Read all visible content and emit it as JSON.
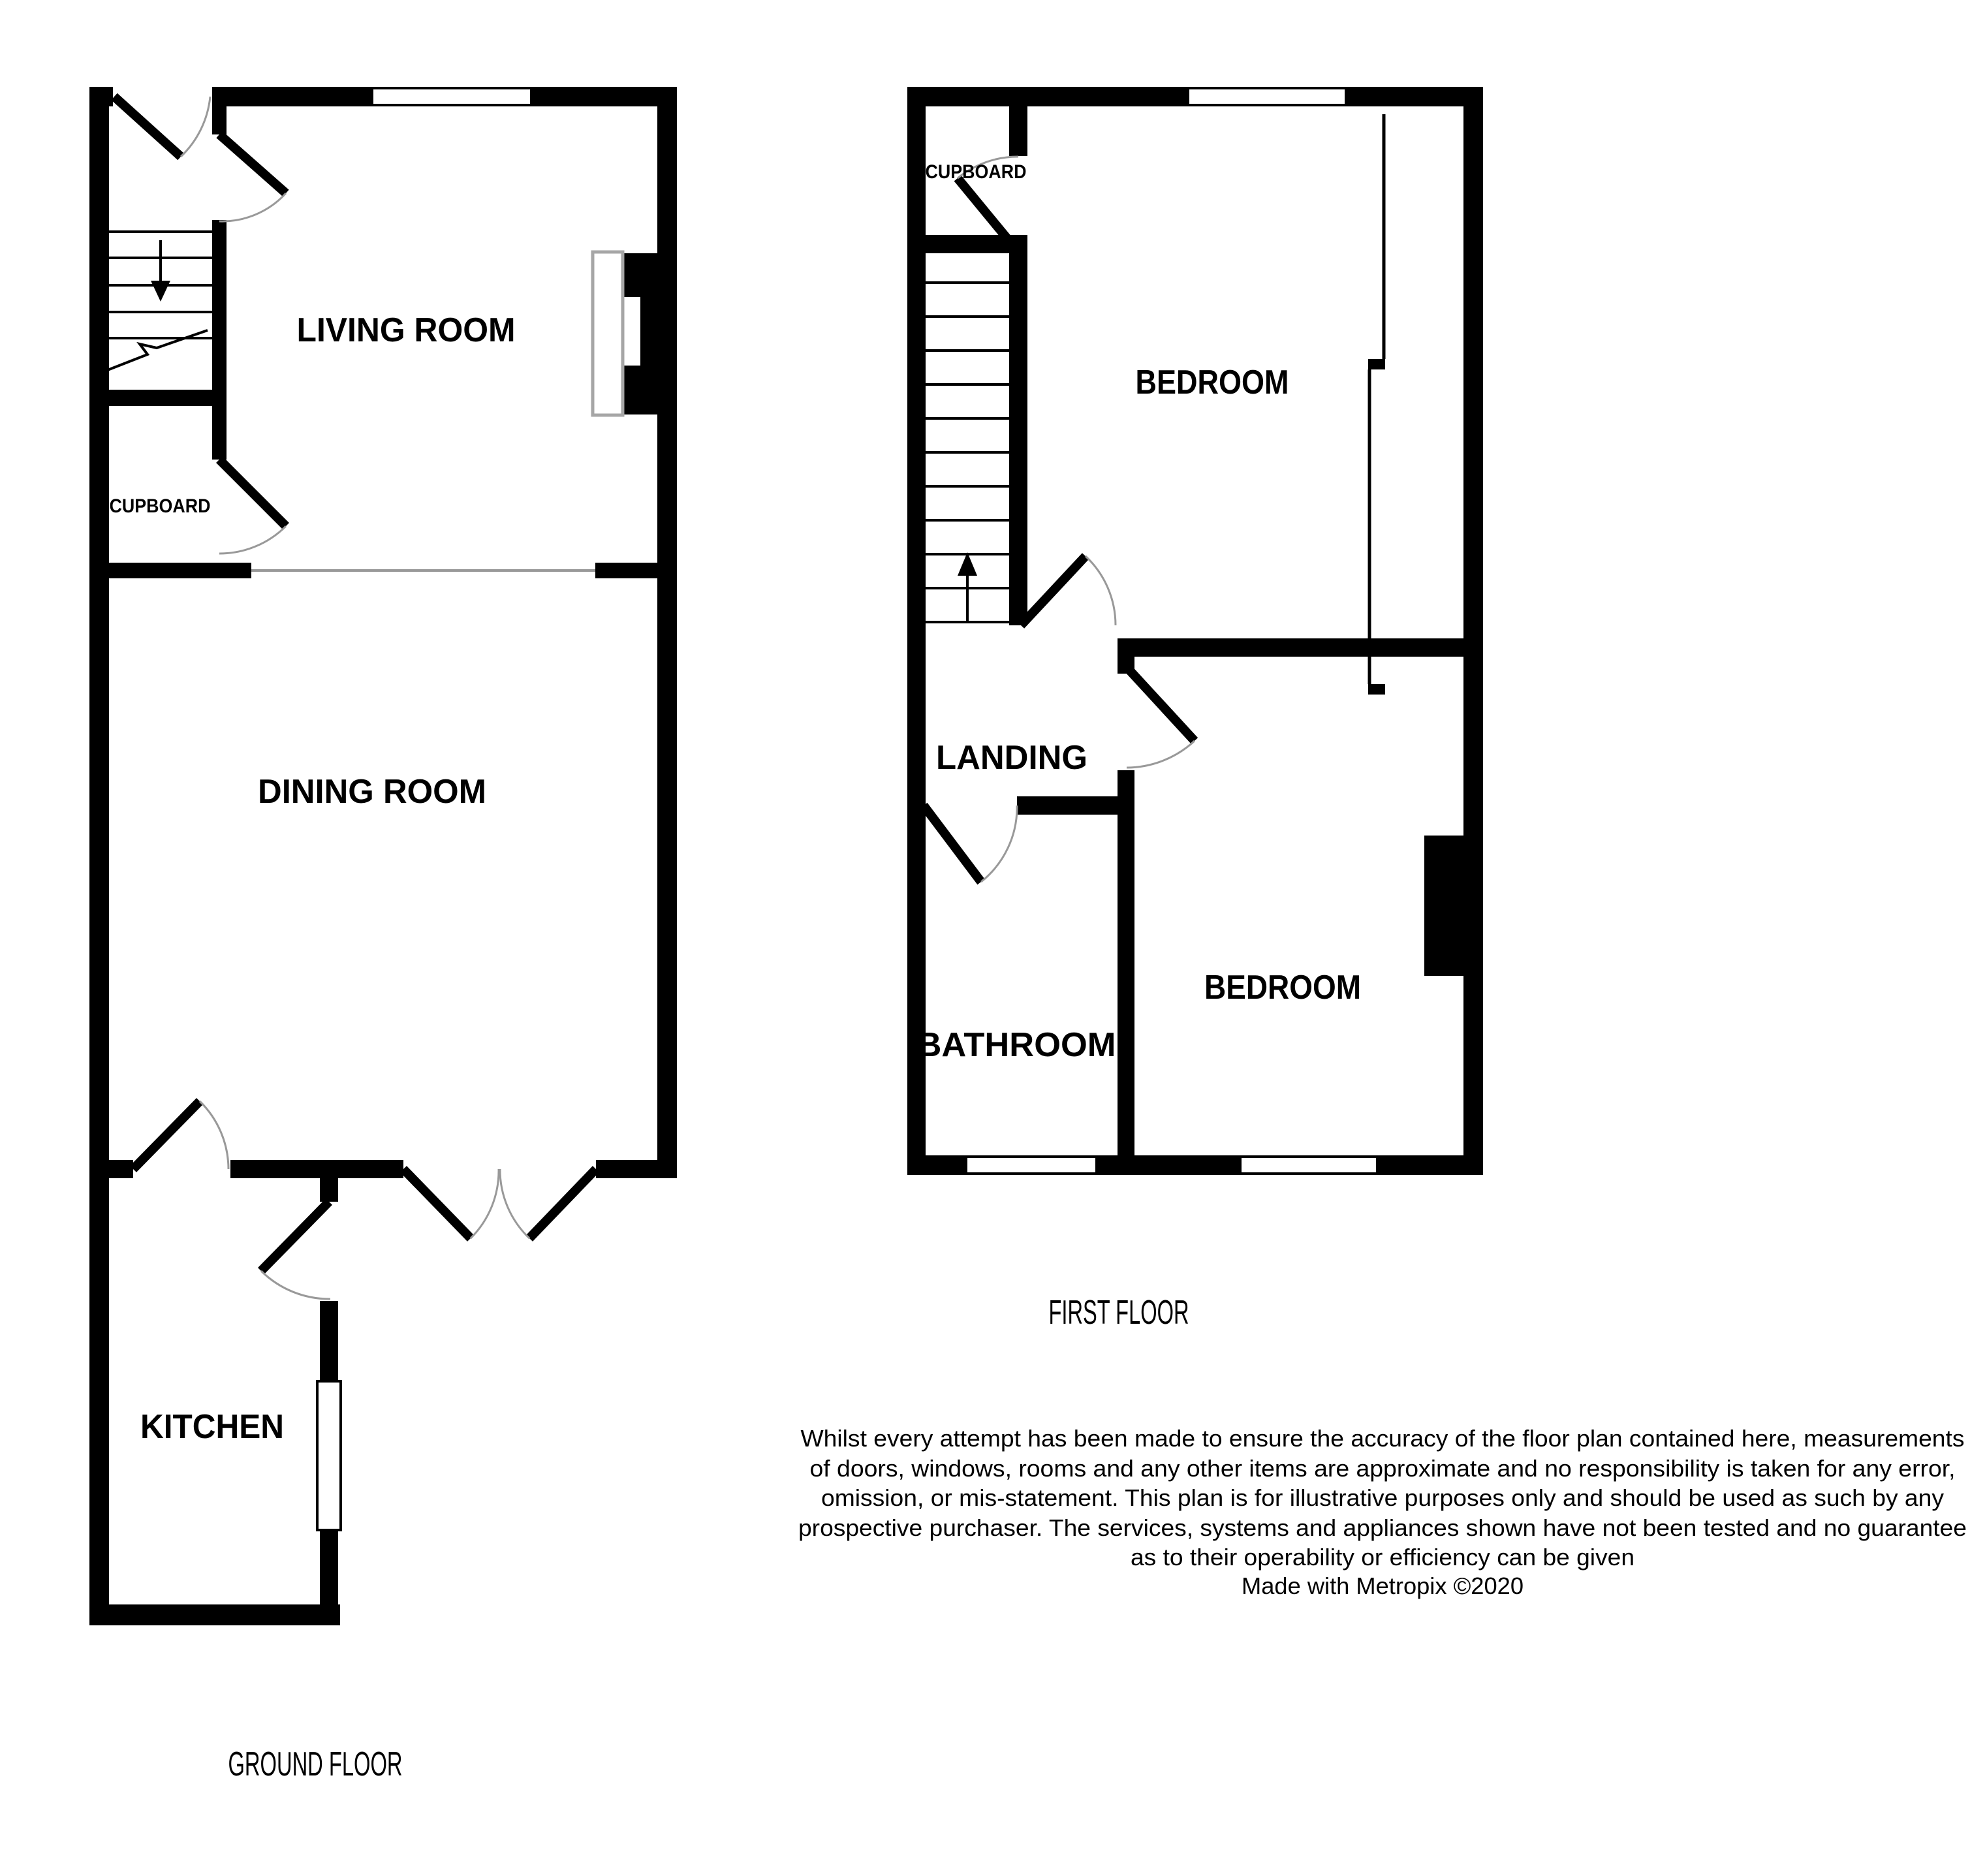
{
  "document": {
    "type": "floorplan",
    "maker_credit": "Made with Metropix ©2020"
  },
  "colors": {
    "background": "#ffffff",
    "wall": "#000000",
    "door_arc": "#999999",
    "room_divider_line": "#999999",
    "hearth_outline": "#a6a6a6",
    "text": "#000000"
  },
  "ground_floor": {
    "title": "GROUND FLOOR",
    "rooms": {
      "living_room": "LIVING ROOM",
      "dining_room": "DINING ROOM",
      "kitchen": "KITCHEN",
      "cupboard": "CUPBOARD"
    }
  },
  "first_floor": {
    "title": "FIRST FLOOR",
    "rooms": {
      "bedroom_front": "BEDROOM",
      "bedroom_back": "BEDROOM",
      "landing": "LANDING",
      "bathroom": "BATHROOM",
      "cupboard": "CUPBOARD"
    }
  },
  "disclaimer": {
    "lines": [
      "Whilst every attempt has been made to ensure the accuracy of the floor plan contained here, measurements",
      "of doors, windows, rooms and any other items are approximate and no responsibility is taken for any error,",
      "omission, or mis-statement. This plan is for illustrative purposes only and should be used as such by any",
      "prospective purchaser. The services, systems and appliances shown have not been tested and no guarantee",
      "as to their operability or efficiency can be given",
      "Made with Metropix ©2020"
    ]
  }
}
